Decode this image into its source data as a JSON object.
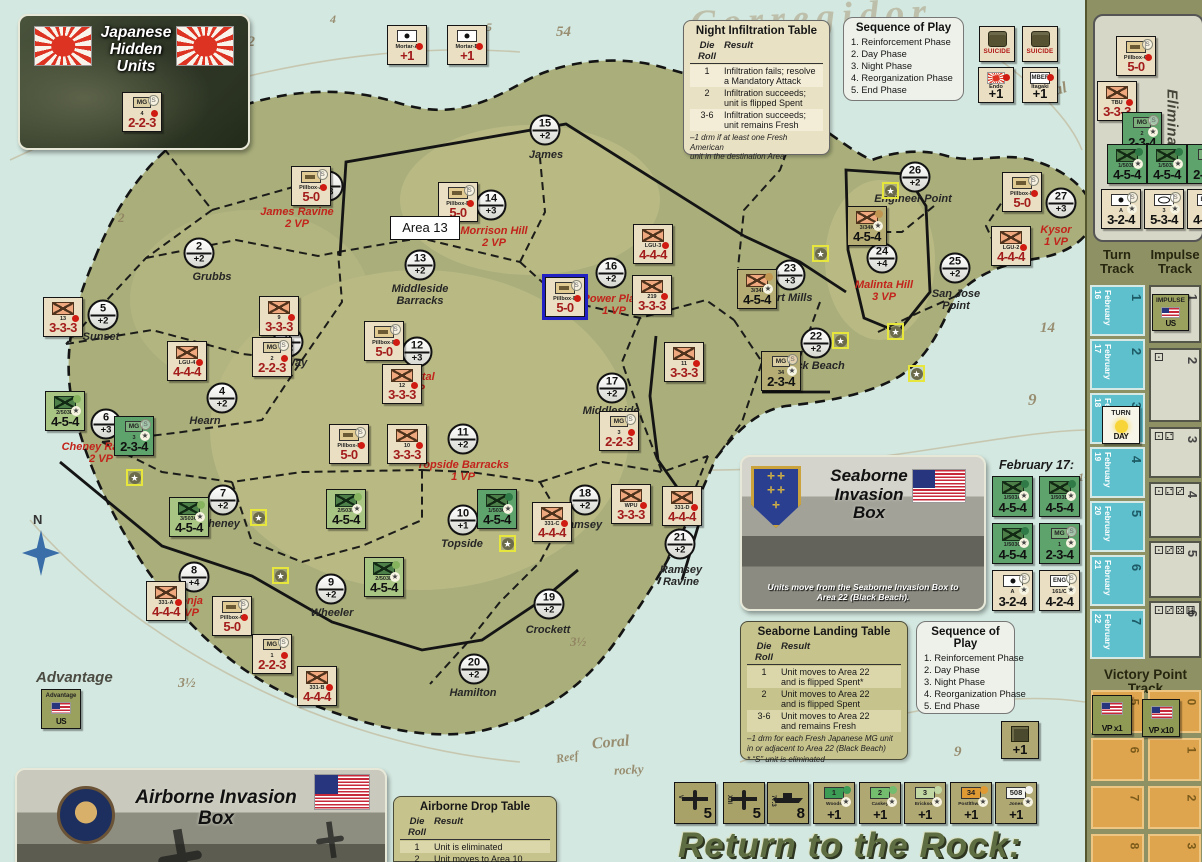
{
  "title": "Return to the Rock:",
  "map": {
    "tooltip": "Area 13",
    "compass_label": "N",
    "advantage_label": "Advantage",
    "february17_label": "February 17:",
    "areas": [
      {
        "n": "1",
        "m": "+3",
        "cx": 328,
        "cy": 186,
        "name": "James Ravine",
        "vp": "2 VP",
        "red": true,
        "lx": 297,
        "ly": 207
      },
      {
        "n": "2",
        "m": "+2",
        "cx": 199,
        "cy": 253,
        "name": "Grubbs",
        "lx": 212,
        "ly": 272
      },
      {
        "n": "3",
        "m": "+2",
        "cx": 288,
        "cy": 342,
        "name": "Way",
        "lx": 296,
        "ly": 358
      },
      {
        "n": "4",
        "m": "+2",
        "cx": 222,
        "cy": 398,
        "name": "Hearn",
        "lx": 205,
        "ly": 416
      },
      {
        "n": "5",
        "m": "+2",
        "cx": 103,
        "cy": 315,
        "name": "Sunset",
        "lx": 101,
        "ly": 332
      },
      {
        "n": "6",
        "m": "+3",
        "cx": 106,
        "cy": 424,
        "name": "Cheney Ravine",
        "vp": "2 VP",
        "red": true,
        "lx": 101,
        "ly": 442
      },
      {
        "n": "7",
        "m": "+2",
        "cx": 223,
        "cy": 500,
        "name": "Cheney",
        "lx": 220,
        "ly": 519
      },
      {
        "n": "8",
        "m": "+4",
        "cx": 194,
        "cy": 577,
        "name": "Monja",
        "vp": "2 VP",
        "red": true,
        "lx": 187,
        "ly": 596
      },
      {
        "n": "9",
        "m": "+2",
        "cx": 331,
        "cy": 589,
        "name": "Wheeler",
        "lx": 332,
        "ly": 608
      },
      {
        "n": "10",
        "m": "+1",
        "cx": 463,
        "cy": 520,
        "name": "Topside",
        "lx": 462,
        "ly": 539
      },
      {
        "n": "11",
        "m": "+2",
        "cx": 463,
        "cy": 439,
        "name": "Topside Barracks",
        "vp": "1 VP",
        "red": true,
        "lx": 463,
        "ly": 460
      },
      {
        "n": "12",
        "m": "+3",
        "cx": 417,
        "cy": 352,
        "name": "Hospital",
        "vp": "1 VP",
        "red": true,
        "lx": 413,
        "ly": 372
      },
      {
        "n": "13",
        "m": "+2",
        "cx": 420,
        "cy": 265,
        "name": "Middleside\nBarracks",
        "lx": 420,
        "ly": 284
      },
      {
        "n": "14",
        "m": "+3",
        "cx": 491,
        "cy": 205,
        "name": "Morrison Hill",
        "vp": "2 VP",
        "red": true,
        "lx": 494,
        "ly": 226
      },
      {
        "n": "15",
        "m": "+2",
        "cx": 545,
        "cy": 130,
        "name": "James",
        "lx": 546,
        "ly": 150
      },
      {
        "n": "16",
        "m": "+2",
        "cx": 611,
        "cy": 273,
        "name": "Power Plant",
        "vp": "1 VP",
        "red": true,
        "lx": 614,
        "ly": 294
      },
      {
        "n": "17",
        "m": "+2",
        "cx": 612,
        "cy": 388,
        "name": "Middleside",
        "lx": 611,
        "ly": 406
      },
      {
        "n": "18",
        "m": "+2",
        "cx": 585,
        "cy": 500,
        "name": "Ramsey",
        "lx": 581,
        "ly": 520
      },
      {
        "n": "19",
        "m": "+2",
        "cx": 549,
        "cy": 604,
        "name": "Crockett",
        "lx": 548,
        "ly": 625
      },
      {
        "n": "20",
        "m": "+2",
        "cx": 474,
        "cy": 669,
        "name": "Hamilton",
        "lx": 473,
        "ly": 688
      },
      {
        "n": "21",
        "m": "+2",
        "cx": 680,
        "cy": 544,
        "name": "Ramsey\nRavine",
        "lx": 681,
        "ly": 565
      },
      {
        "n": "22",
        "m": "+2",
        "cx": 816,
        "cy": 343,
        "name": "Black Beach",
        "lx": 812,
        "ly": 361
      },
      {
        "n": "23",
        "m": "+3",
        "cx": 790,
        "cy": 275,
        "name": "Fort Mills",
        "lx": 788,
        "ly": 293
      },
      {
        "n": "24",
        "m": "+4",
        "cx": 882,
        "cy": 258,
        "name": "Malinta Hill",
        "vp": "3 VP",
        "red": true,
        "lx": 884,
        "ly": 280
      },
      {
        "n": "25",
        "m": "+2",
        "cx": 955,
        "cy": 268,
        "name": "San Jose\nPoint",
        "lx": 956,
        "ly": 289
      },
      {
        "n": "26",
        "m": "+2",
        "cx": 915,
        "cy": 177,
        "name": "Engineer Point",
        "lx": 913,
        "ly": 194
      },
      {
        "n": "27",
        "m": "+3",
        "cx": 1061,
        "cy": 203,
        "name": "Kysor",
        "vp": "1 VP",
        "red": true,
        "lx": 1056,
        "ly": 225
      }
    ],
    "water_labels": [
      {
        "t": "Corregidor",
        "x": 690,
        "y": -4,
        "fs": 38,
        "rot": -3,
        "cls": "ghost"
      },
      {
        "t": "Coral",
        "x": 1030,
        "y": 84,
        "fs": 16,
        "rot": -16
      },
      {
        "t": "Coral",
        "x": 592,
        "y": 734,
        "fs": 16,
        "rot": -5
      },
      {
        "t": "rocky",
        "x": 614,
        "y": 762,
        "fs": 13,
        "rot": -3
      },
      {
        "t": "Reef",
        "x": 556,
        "y": 750,
        "fs": 12,
        "rot": -10
      },
      {
        "t": "54",
        "x": 556,
        "y": 24,
        "fs": 15,
        "rot": 0
      },
      {
        "t": "12",
        "x": 240,
        "y": 34,
        "fs": 15,
        "rot": 0
      },
      {
        "t": "4",
        "x": 330,
        "y": 12,
        "fs": 12,
        "rot": 0
      },
      {
        "t": "5",
        "x": 486,
        "y": 20,
        "fs": 12,
        "rot": 0
      },
      {
        "t": "9",
        "x": 1028,
        "y": 390,
        "fs": 17,
        "rot": 0
      },
      {
        "t": "14",
        "x": 1040,
        "y": 320,
        "fs": 15,
        "rot": 0
      },
      {
        "t": "1¾",
        "x": 1078,
        "y": 470,
        "fs": 12,
        "rot": 0
      },
      {
        "t": "3½",
        "x": 178,
        "y": 676,
        "fs": 14,
        "rot": 0
      },
      {
        "t": "3½",
        "x": 570,
        "y": 634,
        "fs": 13,
        "rot": 0
      },
      {
        "t": "9",
        "x": 954,
        "y": 744,
        "fs": 15,
        "rot": 0
      },
      {
        "t": "2",
        "x": 118,
        "y": 210,
        "fs": 13,
        "rot": 0
      }
    ],
    "stars": [
      {
        "x": 126,
        "y": 469
      },
      {
        "x": 250,
        "y": 509
      },
      {
        "x": 272,
        "y": 567
      },
      {
        "x": 499,
        "y": 535
      },
      {
        "x": 882,
        "y": 182
      },
      {
        "x": 812,
        "y": 245
      },
      {
        "x": 887,
        "y": 323
      },
      {
        "x": 908,
        "y": 365
      },
      {
        "x": 832,
        "y": 332
      }
    ]
  },
  "tables": {
    "night_infiltration": {
      "title": "Night Infiltration Table",
      "col_die": "Die Roll",
      "col_result": "Result",
      "rows": [
        {
          "die": "1",
          "result": "Infiltration fails; resolve\na Mandatory Attack",
          "hl": true
        },
        {
          "die": "2",
          "result": "Infiltration succeeds;\nunit is flipped Spent",
          "hl": false
        },
        {
          "die": "3-6",
          "result": "Infiltration succeeds;\nunit remains Fresh",
          "hl": true
        }
      ],
      "notes": [
        "–1 drm if at least one Fresh American\nunit in the destination Area"
      ]
    },
    "seaborne_landing": {
      "title": "Seaborne Landing Table",
      "col_die": "Die Roll",
      "col_result": "Result",
      "rows": [
        {
          "die": "1",
          "result": "Unit moves to Area 22\nand is flipped Spent*",
          "hl": true
        },
        {
          "die": "2",
          "result": "Unit moves to Area 22\nand is flipped Spent",
          "hl": false
        },
        {
          "die": "3-6",
          "result": "Unit moves to Area 22\nand remains Fresh",
          "hl": true
        }
      ],
      "notes": [
        "–1 drm for each Fresh Japanese MG unit\nin or adjacent to Area 22 (Black Beach)",
        "* “S” unit is eliminated"
      ]
    },
    "airborne_drop": {
      "title": "Airborne Drop Table",
      "col_die": "Die Roll",
      "col_result": "Result",
      "rows": [
        {
          "die": "1",
          "result": "Unit is eliminated",
          "hl": true
        },
        {
          "die": "2",
          "result": "Unit moves to Area 10\nand is flipped Spent",
          "hl": false
        }
      ],
      "notes": []
    },
    "sequence_of_play": {
      "title": "Sequence of Play",
      "items": [
        "1. Reinforcement Phase",
        "2. Day Phase",
        "3. Night Phase",
        "4. Reorganization Phase",
        "5. End Phase"
      ]
    }
  },
  "boxes": {
    "japanese_hidden": {
      "title": "Japanese\nHidden\nUnits"
    },
    "seaborne": {
      "title": "Seaborne\nInvasion\nBox",
      "note": "Units move from the Seaborne Invasion Box to\nArea 22 (Black Beach)."
    },
    "airborne": {
      "title": "Airborne Invasion Box"
    }
  },
  "sidebar": {
    "eliminated_label": "Eliminated",
    "turn_track_title": "Turn\nTrack",
    "impulse_track_title": "Impulse\nTrack",
    "vp_track_title": "Victory Point Track",
    "turn_cells": [
      {
        "n": "1",
        "date": "February 16",
        "top": 285,
        "h": 51
      },
      {
        "n": "2",
        "date": "February 17",
        "top": 339,
        "h": 51
      },
      {
        "n": "3",
        "date": "February 18",
        "top": 393,
        "h": 51
      },
      {
        "n": "4",
        "date": "February 19",
        "top": 447,
        "h": 51
      },
      {
        "n": "5",
        "date": "February 20",
        "top": 501,
        "h": 51
      },
      {
        "n": "6",
        "date": "February 21",
        "top": 555,
        "h": 51
      },
      {
        "n": "7",
        "date": "February 22",
        "top": 609,
        "h": 50
      }
    ],
    "impulse_cells": [
      {
        "n": "1",
        "dice": "",
        "top": 285,
        "h": 58
      },
      {
        "n": "2",
        "dice": "⚀",
        "top": 348,
        "h": 74
      },
      {
        "n": "3",
        "dice": "⚀⚁",
        "top": 427,
        "h": 51
      },
      {
        "n": "4",
        "dice": "⚀⚁⚂",
        "top": 482,
        "h": 56
      },
      {
        "n": "5",
        "dice": "⚀⚂⚄",
        "top": 541,
        "h": 57
      },
      {
        "n": "6",
        "dice": "⚀⚂⚄⚅",
        "top": 601,
        "h": 57
      }
    ],
    "vp_left": [
      "5",
      "6",
      "7",
      "8"
    ],
    "vp_right": [
      "0",
      "1",
      "2",
      "3"
    ]
  },
  "counter_text": {
    "suicide": "SUICIDE",
    "mbef": "MBEF",
    "impulse": "IMPULSE",
    "us": "US",
    "turn": "TURN",
    "day": "DAY",
    "advantage": "Advantage",
    "vp1": "VP x1",
    "vp10": "VP x10",
    "eng": "ENG",
    "mg": "MG"
  },
  "counters": [
    {
      "x": 291,
      "y": 166,
      "k": "jppb",
      "u": "Pillbox-A",
      "s": "5-0"
    },
    {
      "x": 438,
      "y": 182,
      "k": "jppb",
      "u": "Pillbox-E",
      "s": "5-0"
    },
    {
      "x": 633,
      "y": 224,
      "k": "jpinf",
      "u": "LGU-3",
      "s": "4-4-4"
    },
    {
      "x": 632,
      "y": 275,
      "k": "jpinf",
      "u": "219",
      "s": "3-3-3"
    },
    {
      "x": 545,
      "y": 277,
      "k": "jppb",
      "u": "Pillbox-B",
      "s": "5-0",
      "sel": true
    },
    {
      "x": 43,
      "y": 297,
      "k": "jpinf",
      "u": "13",
      "s": "3-3-3"
    },
    {
      "x": 259,
      "y": 296,
      "k": "jpinf",
      "u": "9",
      "s": "3-3-3"
    },
    {
      "x": 252,
      "y": 337,
      "k": "jpmg",
      "u": "2",
      "s": "2-2-3"
    },
    {
      "x": 167,
      "y": 341,
      "k": "jpinf",
      "u": "LGU-4",
      "s": "4-4-4"
    },
    {
      "x": 364,
      "y": 321,
      "k": "jppb",
      "u": "Pillbox-D",
      "s": "5-0"
    },
    {
      "x": 382,
      "y": 364,
      "k": "jpinf",
      "u": "12",
      "s": "3-3-3"
    },
    {
      "x": 329,
      "y": 424,
      "k": "jppb",
      "u": "Pillbox-F",
      "s": "5-0"
    },
    {
      "x": 387,
      "y": 424,
      "k": "jpinf",
      "u": "10",
      "s": "3-3-3"
    },
    {
      "x": 599,
      "y": 411,
      "k": "jpmg",
      "u": "3",
      "s": "2-2-3"
    },
    {
      "x": 664,
      "y": 342,
      "k": "jpinf",
      "u": "11",
      "s": "3-3-3"
    },
    {
      "x": 146,
      "y": 581,
      "k": "jpinf",
      "u": "331-A",
      "s": "4-4-4"
    },
    {
      "x": 212,
      "y": 596,
      "k": "jppb",
      "u": "Pillbox-C",
      "s": "5-0"
    },
    {
      "x": 252,
      "y": 634,
      "k": "jpmg",
      "u": "1",
      "s": "2-2-3"
    },
    {
      "x": 297,
      "y": 666,
      "k": "jpinf",
      "u": "331-B",
      "s": "4-4-4"
    },
    {
      "x": 532,
      "y": 502,
      "k": "jpinf",
      "u": "331-C",
      "s": "4-4-4"
    },
    {
      "x": 611,
      "y": 484,
      "k": "jpinf",
      "u": "WPU",
      "s": "3-3-3"
    },
    {
      "x": 662,
      "y": 486,
      "k": "jpinf",
      "u": "331-D",
      "s": "4-4-4"
    },
    {
      "x": 1002,
      "y": 172,
      "k": "jppb",
      "u": "Pillbox-H",
      "s": "5-0"
    },
    {
      "x": 991,
      "y": 226,
      "k": "jpinf",
      "u": "LGU-2",
      "s": "4-4-4"
    },
    {
      "x": 45,
      "y": 391,
      "k": "usparaL",
      "u": "2/503D",
      "s": "4-5-4"
    },
    {
      "x": 114,
      "y": 416,
      "k": "usmg",
      "u": "3",
      "s": "2-3-4"
    },
    {
      "x": 169,
      "y": 497,
      "k": "usparaL",
      "u": "3/503G",
      "s": "4-5-4"
    },
    {
      "x": 326,
      "y": 489,
      "k": "usparaL",
      "u": "2/503F",
      "s": "4-5-4"
    },
    {
      "x": 477,
      "y": 489,
      "k": "usparaD",
      "u": "1/503C",
      "s": "4-5-4"
    },
    {
      "x": 364,
      "y": 557,
      "k": "usparaL",
      "u": "2/503E",
      "s": "4-5-4"
    },
    {
      "x": 737,
      "y": 269,
      "k": "us34",
      "u": "3/34I",
      "s": "4-5-4"
    },
    {
      "x": 847,
      "y": 206,
      "k": "us34",
      "u": "3/34K",
      "s": "4-5-4"
    },
    {
      "x": 761,
      "y": 351,
      "k": "usmg34",
      "u": "34",
      "s": "2-3-4"
    },
    {
      "x": 387,
      "y": 25,
      "k": "mortar",
      "u": "Mortar-A",
      "s": "+1"
    },
    {
      "x": 447,
      "y": 25,
      "k": "mortar",
      "u": "Mortar-B",
      "s": "+1"
    },
    {
      "x": 979,
      "y": 26,
      "k": "suicide",
      "sz": 36
    },
    {
      "x": 1022,
      "y": 26,
      "k": "suicide",
      "sz": 36
    },
    {
      "x": 978,
      "y": 67,
      "k": "endo",
      "u": "Endo",
      "s": "+1",
      "sz": 36
    },
    {
      "x": 1022,
      "y": 67,
      "k": "mbef",
      "u": "Itagaki",
      "s": "+1",
      "sz": 36
    },
    {
      "x": 122,
      "y": 92,
      "k": "jpmg",
      "u": "4",
      "s": "2-2-3"
    },
    {
      "x": 992,
      "y": 476,
      "k": "usparaD",
      "u": "1/503A",
      "s": "4-5-4",
      "sz": 41
    },
    {
      "x": 1039,
      "y": 476,
      "k": "usparaD",
      "u": "1/503B",
      "s": "4-5-4",
      "sz": 41
    },
    {
      "x": 992,
      "y": 523,
      "k": "usparaD",
      "u": "1/503C",
      "s": "4-5-4",
      "sz": 41
    },
    {
      "x": 1039,
      "y": 523,
      "k": "usmg",
      "u": "1",
      "s": "2-3-4",
      "sz": 41
    },
    {
      "x": 992,
      "y": 570,
      "k": "uswhite",
      "u": "A",
      "s": "3-2-4",
      "sz": 41
    },
    {
      "x": 1039,
      "y": 570,
      "k": "useng",
      "u": "161/C",
      "s": "4-2-4",
      "sz": 41
    },
    {
      "x": 1116,
      "y": 36,
      "k": "jppb",
      "u": "Pillbox-G",
      "s": "5-0"
    },
    {
      "x": 1097,
      "y": 81,
      "k": "jpinf",
      "u": "TBU",
      "s": "3-3-3"
    },
    {
      "x": 1122,
      "y": 112,
      "k": "usmg",
      "u": "2",
      "s": "2-3-4"
    },
    {
      "x": 1107,
      "y": 144,
      "k": "usparaD",
      "u": "1/503B",
      "s": "4-5-4"
    },
    {
      "x": 1147,
      "y": 144,
      "k": "usparaD",
      "u": "1/503A",
      "s": "4-5-4"
    },
    {
      "x": 1187,
      "y": 144,
      "k": "usmg",
      "u": "1",
      "s": "2-3-4"
    },
    {
      "x": 1101,
      "y": 189,
      "k": "uswhite",
      "u": "A",
      "s": "3-2-4"
    },
    {
      "x": 1144,
      "y": 189,
      "k": "usoval",
      "u": "3",
      "s": "5-3-4"
    },
    {
      "x": 1187,
      "y": 189,
      "k": "useng",
      "u": "161",
      "s": "4-2-4"
    },
    {
      "x": 674,
      "y": 782,
      "k": "plane",
      "u": "V",
      "s": "5",
      "sz": 42
    },
    {
      "x": 723,
      "y": 782,
      "k": "plane",
      "u": "XIII",
      "s": "5",
      "sz": 42
    },
    {
      "x": 767,
      "y": 782,
      "k": "ship",
      "u": "77.3",
      "s": "8",
      "sz": 42
    },
    {
      "x": 813,
      "y": 782,
      "k": "leader",
      "u": "1",
      "nm": "Woods",
      "s": "+1",
      "c": "#3c9b55",
      "sz": 42
    },
    {
      "x": 859,
      "y": 782,
      "k": "leader",
      "u": "2",
      "nm": "Caskey",
      "s": "+1",
      "c": "#74bd6e",
      "sz": 42
    },
    {
      "x": 904,
      "y": 782,
      "k": "leader",
      "u": "3",
      "nm": "Erickson",
      "s": "+1",
      "c": "#c2d8a4",
      "sz": 42
    },
    {
      "x": 950,
      "y": 782,
      "k": "leader",
      "u": "34",
      "nm": "Postlthwait",
      "s": "+1",
      "c": "#e09a33",
      "sz": 42
    },
    {
      "x": 995,
      "y": 782,
      "k": "leader",
      "u": "508",
      "nm": "Jones",
      "s": "+1",
      "c": "#f5f5f0",
      "sz": 42
    },
    {
      "x": 1001,
      "y": 721,
      "k": "equip",
      "s": "+1",
      "sz": 38
    },
    {
      "x": 41,
      "y": 689,
      "k": "advantage",
      "sz": 40
    },
    {
      "x": 1152,
      "y": 294,
      "k": "impulseus",
      "sz": 37
    },
    {
      "x": 1102,
      "y": 406,
      "k": "turnday",
      "sz": 38
    },
    {
      "x": 1092,
      "y": 695,
      "k": "vpx1",
      "sz": 40
    },
    {
      "x": 1142,
      "y": 699,
      "k": "vpx10",
      "sz": 38
    }
  ]
}
